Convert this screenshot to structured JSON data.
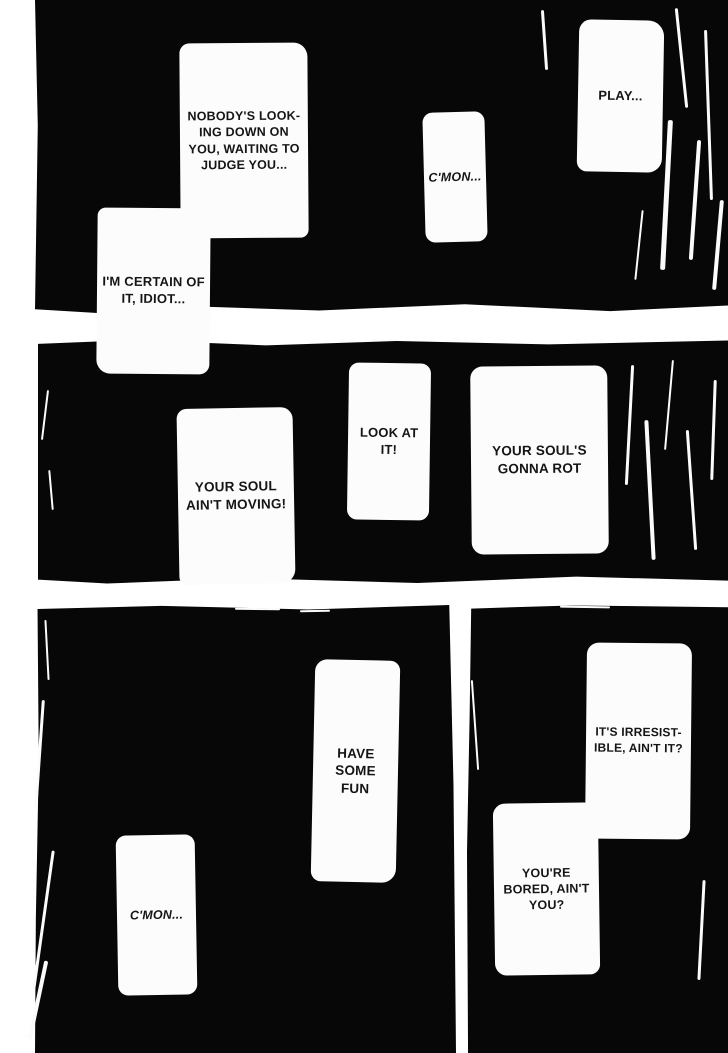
{
  "page": {
    "type": "manga-page",
    "colors": {
      "paper": "#ffffff",
      "ink": "#070707",
      "bubble": "#fcfcfc",
      "text": "#151515"
    }
  },
  "panels": [
    {
      "name": "top-panel",
      "speech": [
        "PLAY...",
        "C'MON...",
        "NOBODY'S LOOK-\nING DOWN ON\nYOU, WAITING TO\nJUDGE YOU...",
        "I'M CERTAIN OF\nIT, IDIOT..."
      ]
    },
    {
      "name": "middle-panel",
      "speech": [
        "YOUR SOUL'S\nGONNA ROT",
        "LOOK AT\nIT!",
        "YOUR SOUL\nAIN'T MOVING!"
      ]
    },
    {
      "name": "bottom-right-panel",
      "speech": [
        "IT'S IRRESIST-\nIBLE, AIN'T IT?",
        "YOU'RE\nBORED, AIN'T\nYOU?"
      ]
    },
    {
      "name": "bottom-left-panel",
      "speech": [
        "HAVE SOME\nFUN",
        "C'MON..."
      ]
    }
  ]
}
